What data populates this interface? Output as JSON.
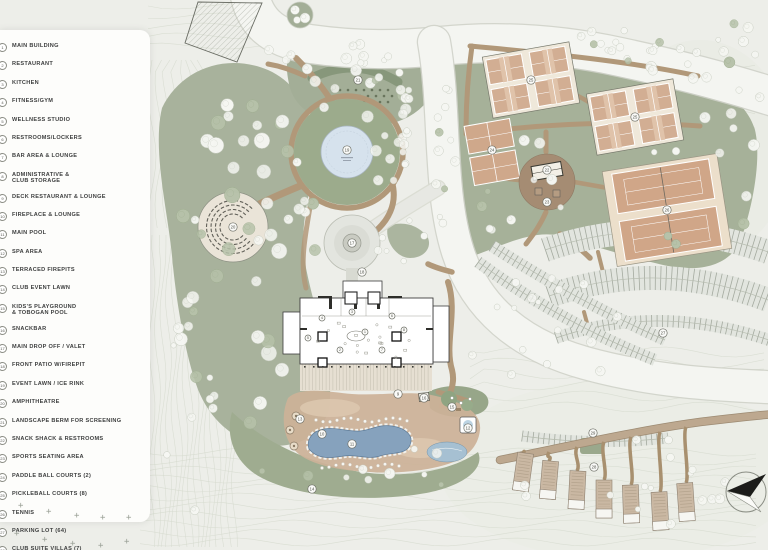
{
  "legend": {
    "items": [
      {
        "n": 1,
        "label": "MAIN BUILDING"
      },
      {
        "n": 2,
        "label": "RESTAURANT"
      },
      {
        "n": 3,
        "label": "KITCHEN"
      },
      {
        "n": 4,
        "label": "FITNESS/GYM"
      },
      {
        "n": 5,
        "label": "WELLNESS STUDIO"
      },
      {
        "n": 6,
        "label": "RESTROOMS/LOCKERS"
      },
      {
        "n": 7,
        "label": "BAR AREA & LOUNGE"
      },
      {
        "n": 8,
        "label": "ADMINISTRATIVE &\nCLUB STORAGE"
      },
      {
        "n": 9,
        "label": "DECK RESTAURANT & LOUNGE"
      },
      {
        "n": 10,
        "label": "FIREPLACE & LOUNGE"
      },
      {
        "n": 11,
        "label": "MAIN POOL"
      },
      {
        "n": 12,
        "label": "SPA AREA"
      },
      {
        "n": 13,
        "label": "TERRACED FIREPITS"
      },
      {
        "n": 14,
        "label": "CLUB EVENT LAWN"
      },
      {
        "n": 15,
        "label": "KIDS'S PLAYGROUND\n& TOBOGAN POOL"
      },
      {
        "n": 16,
        "label": "SNACKBAR"
      },
      {
        "n": 17,
        "label": "MAIN DROP OFF / VALET"
      },
      {
        "n": 18,
        "label": "FRONT PATIO W/FIREPIT"
      },
      {
        "n": 19,
        "label": "EVENT LAWN / ICE RINK"
      },
      {
        "n": 20,
        "label": "AMPHITHEATRE"
      },
      {
        "n": 21,
        "label": "LANDSCAPE BERM FOR SCREENING"
      },
      {
        "n": 22,
        "label": "SNACK SHACK & RESTROOMS"
      },
      {
        "n": 23,
        "label": "SPORTS SEATING AREA"
      },
      {
        "n": 24,
        "label": "PADDLE BALL COURTS (2)"
      },
      {
        "n": 25,
        "label": "PICKLEBALL COURTS (8)"
      },
      {
        "n": 26,
        "label": "TENNIS"
      },
      {
        "n": 27,
        "label": "PARKING LOT (64)"
      },
      {
        "n": 28,
        "label": "CLUB SUITE VILLAS (7)"
      },
      {
        "n": 29,
        "label": "SUITE VILLAS PARKING LOT (16)"
      }
    ]
  },
  "map": {
    "markers": [
      {
        "n": 1,
        "x": 365,
        "y": 332,
        "s": "sm"
      },
      {
        "n": 2,
        "x": 340,
        "y": 350,
        "s": "sm"
      },
      {
        "n": 3,
        "x": 352,
        "y": 312,
        "s": "sm"
      },
      {
        "n": 4,
        "x": 322,
        "y": 318,
        "s": "sm"
      },
      {
        "n": 5,
        "x": 308,
        "y": 338,
        "s": "sm"
      },
      {
        "n": 6,
        "x": 392,
        "y": 316,
        "s": "sm"
      },
      {
        "n": 7,
        "x": 382,
        "y": 350,
        "s": "sm"
      },
      {
        "n": 8,
        "x": 404,
        "y": 330,
        "s": "sm"
      },
      {
        "n": 9,
        "x": 398,
        "y": 394
      },
      {
        "n": 10,
        "x": 322,
        "y": 434
      },
      {
        "n": 11,
        "x": 352,
        "y": 444
      },
      {
        "n": 12,
        "x": 468,
        "y": 428
      },
      {
        "n": 13,
        "x": 300,
        "y": 419
      },
      {
        "n": 14,
        "x": 312,
        "y": 489
      },
      {
        "n": 15,
        "x": 452,
        "y": 407
      },
      {
        "n": 16,
        "x": 424,
        "y": 398
      },
      {
        "n": 17,
        "x": 352,
        "y": 243
      },
      {
        "n": 18,
        "x": 362,
        "y": 272
      },
      {
        "n": 19,
        "x": 347,
        "y": 150
      },
      {
        "n": 20,
        "x": 233,
        "y": 227
      },
      {
        "n": 21,
        "x": 358,
        "y": 80
      },
      {
        "n": 22,
        "x": 547,
        "y": 170
      },
      {
        "n": 23,
        "x": 547,
        "y": 202
      },
      {
        "n": 24,
        "x": 492,
        "y": 150
      },
      {
        "n": 25,
        "x": 531,
        "y": 80
      },
      {
        "n": 25,
        "x": 635,
        "y": 117
      },
      {
        "n": 26,
        "x": 667,
        "y": 210
      },
      {
        "n": 27,
        "x": 663,
        "y": 333
      },
      {
        "n": 28,
        "x": 594,
        "y": 467
      },
      {
        "n": 29,
        "x": 593,
        "y": 433
      }
    ],
    "colors": {
      "bg": "#edeee9",
      "panel": "#fdfdfb",
      "text": "#3f4040",
      "sage": "#a8b29c",
      "sageDark": "#87977b",
      "lawn": "#a3ae97",
      "lawn2": "#9fac90",
      "courtGreen": "#a6b199",
      "rinkGreen": "#9cab8c",
      "roadFill": "#f4f5f1",
      "roadEdge": "#cfd2c9",
      "connector": "#e7e8e3",
      "path": "#b19879",
      "pathDark": "#9c8a72",
      "courtCream": "#efe8da",
      "courtSalmon": "#d2ae93",
      "courtDeep": "#d0a688",
      "tennisPad": "#ecdfcb",
      "poolBlue": "#86a2bd",
      "poolEdge": "#5f7d9a",
      "rinkBlue": "#d6e2ed",
      "kidsPool": "#a6c0d2",
      "deck": "#ccb298",
      "deckLight": "#dcc7ae",
      "parkFill": "#e2e5df",
      "parkTick": "#8f958a",
      "villa": "#cab8a3",
      "villaEdge": "#8f8272",
      "treeWhite": "#f6f7f3",
      "treeEdge": "#c6cbbf",
      "treeSage": "#b7c2aa",
      "treeSageEdge": "#9fae90",
      "contour": "#d6dacf",
      "plaza": "#a58b72",
      "berm": "#87977b",
      "bermDot": "#5f6b52",
      "buildingLine": "#3d3d3d",
      "marker": "#6d6f66"
    }
  }
}
